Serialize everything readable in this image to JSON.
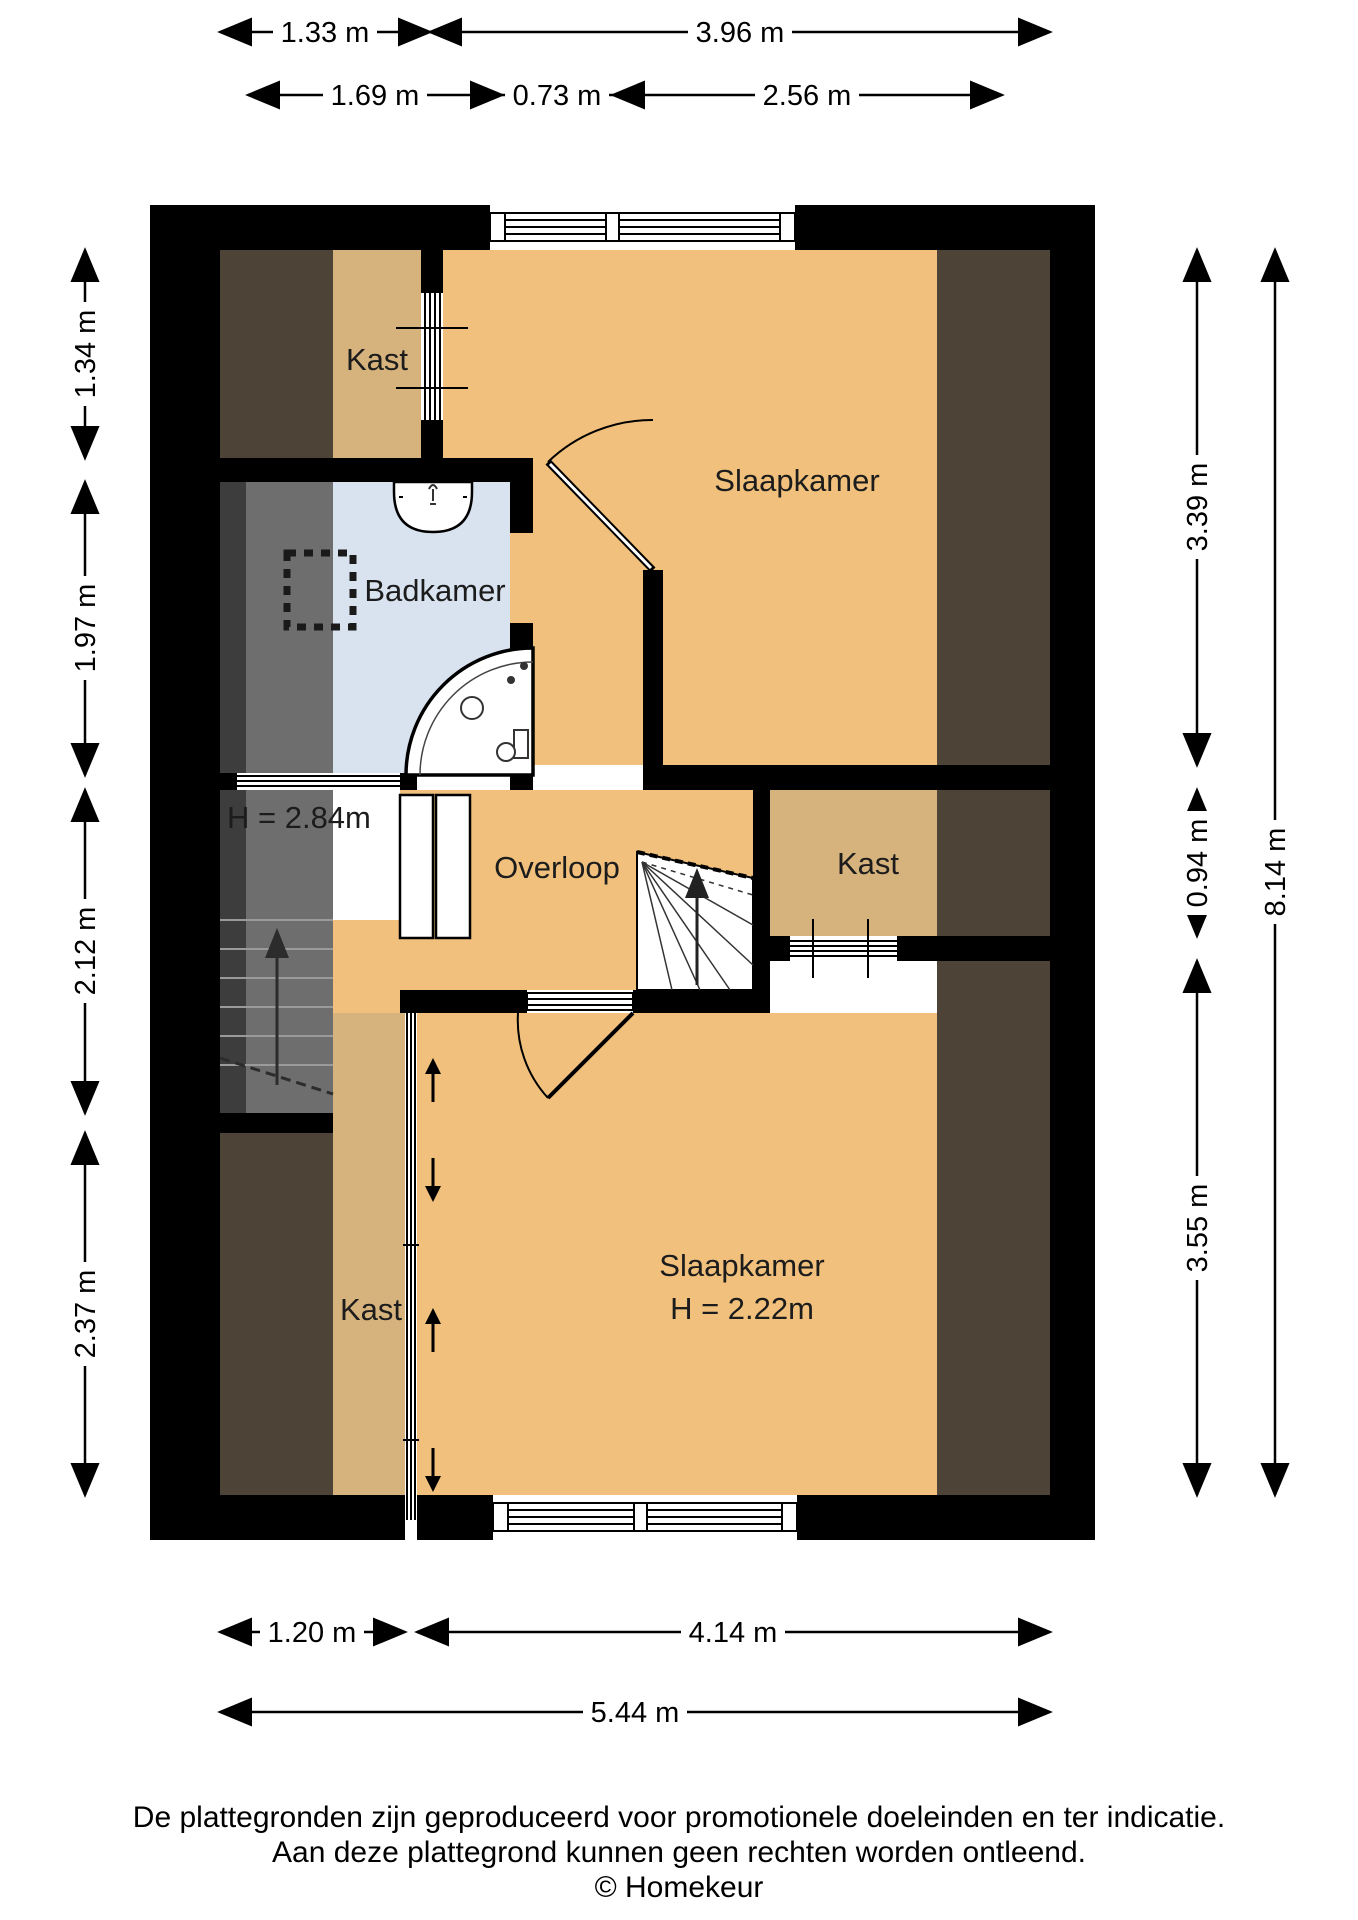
{
  "rooms": {
    "kast_top": "Kast",
    "slaapkamer_top": "Slaapkamer",
    "badkamer": "Badkamer",
    "overloop": "Overloop",
    "kast_mid": "Kast",
    "kast_bottom": "Kast",
    "slaapkamer_bottom": "Slaapkamer",
    "slaapkamer_bottom_height": "H = 2.22m",
    "stairwell_height": "H = 2.84m"
  },
  "dimensions": {
    "top_row1": [
      "1.33 m",
      "3.96 m"
    ],
    "top_row2": [
      "1.69 m",
      "0.73 m",
      "2.56 m"
    ],
    "left": [
      "1.34 m",
      "1.97 m",
      "2.12 m",
      "2.37 m"
    ],
    "right_inner": [
      "3.39 m",
      "0.94 m",
      "3.55 m"
    ],
    "right_outer": "8.14 m",
    "bottom_row1": [
      "1.20 m",
      "4.14 m"
    ],
    "bottom_row2": "5.44 m"
  },
  "footer": {
    "line1": "De plattegronden zijn geproduceerd voor promotionele doeleinden en ter indicatie.",
    "line2": "Aan deze plattegrond kunnen geen rechten worden ontleend.",
    "line3": "© Homekeur"
  },
  "colors": {
    "wall": "#000000",
    "floor": "#F0C07C",
    "closet": "#D6B27D",
    "low_headroom": "#4D4337",
    "bathroom": "#D9E3F0",
    "stairs": "#6E6E6E",
    "stairs_dark": "#3D3D3D"
  }
}
